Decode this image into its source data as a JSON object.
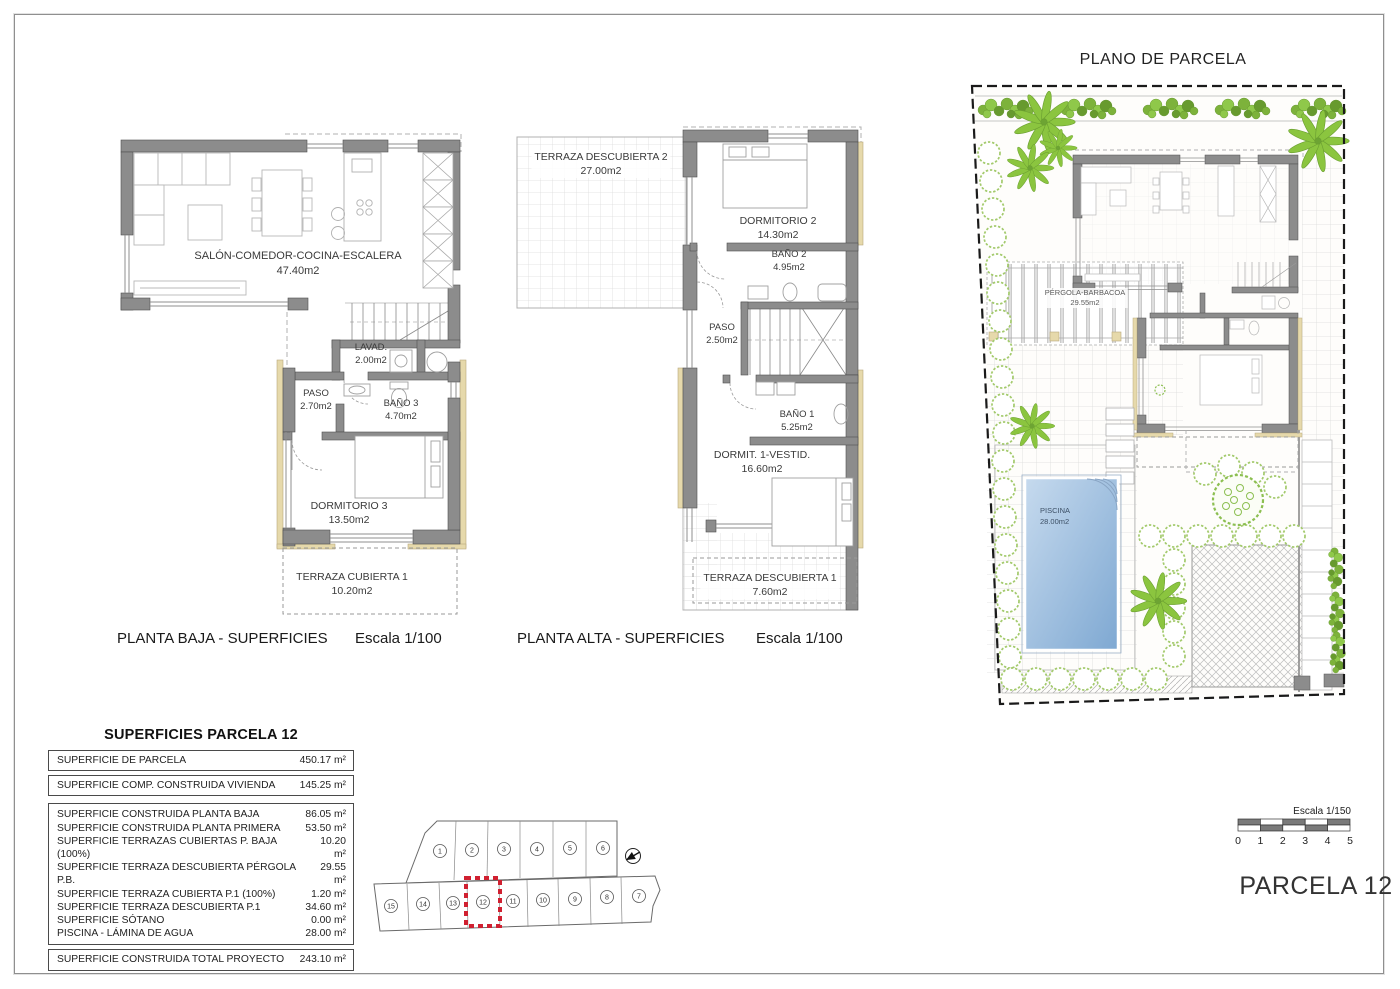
{
  "colors": {
    "wall_gray": "#8c8c8c",
    "beige_accent": "#e6d9ab",
    "vegetation_green": "#8bc53f",
    "pool_blue": "#8fb4da",
    "highlight_red": "#d02030"
  },
  "plans": {
    "baja": {
      "title": "PLANTA BAJA - SUPERFICIES",
      "scale": "Escala 1/100",
      "rooms": [
        {
          "name": "SALÓN-COMEDOR-COCINA-ESCALERA",
          "area": "47.40m2"
        },
        {
          "name": "LAVAD.",
          "area": "2.00m2"
        },
        {
          "name": "PASO",
          "area": "2.70m2"
        },
        {
          "name": "BAÑO 3",
          "area": "4.70m2"
        },
        {
          "name": "DORMITORIO 3",
          "area": "13.50m2"
        },
        {
          "name": "TERRAZA CUBIERTA 1",
          "area": "10.20m2"
        }
      ]
    },
    "alta": {
      "title": "PLANTA ALTA - SUPERFICIES",
      "scale": "Escala 1/100",
      "rooms": [
        {
          "name": "TERRAZA DESCUBIERTA 2",
          "area": "27.00m2"
        },
        {
          "name": "DORMITORIO 2",
          "area": "14.30m2"
        },
        {
          "name": "BAÑO 2",
          "area": "4.95m2"
        },
        {
          "name": "PASO",
          "area": "2.50m2"
        },
        {
          "name": "BAÑO 1",
          "area": "5.25m2"
        },
        {
          "name": "DORMIT. 1-VESTID.",
          "area": "16.60m2"
        },
        {
          "name": "TERRAZA DESCUBIERTA 1",
          "area": "7.60m2"
        }
      ]
    },
    "parcela": {
      "title": "PLANO DE PARCELA",
      "label": "PARCELA 12",
      "rooms": [
        {
          "name": "PÉRGOLA-BARBACOA",
          "area": "29.55m2"
        },
        {
          "name": "PISCINA",
          "area": "28.00m2"
        }
      ]
    }
  },
  "scalebar": {
    "label": "Escala 1/150",
    "ticks": [
      "0",
      "1",
      "2",
      "3",
      "4",
      "5"
    ]
  },
  "plot_map": {
    "top_row": [
      "1",
      "2",
      "3",
      "4",
      "5",
      "6"
    ],
    "bottom_row": [
      "15",
      "14",
      "13",
      "12",
      "11",
      "10",
      "9",
      "8",
      "7"
    ],
    "highlighted_plot": "12"
  },
  "table": {
    "title": "SUPERFICIES PARCELA 12",
    "sections": [
      [
        {
          "label": "SUPERFICIE DE PARCELA",
          "value": "450.17 m²"
        }
      ],
      [
        {
          "label": "SUPERFICIE COMP. CONSTRUIDA VIVIENDA",
          "value": "145.25 m²"
        }
      ],
      [
        {
          "label": "SUPERFICIE CONSTRUIDA PLANTA BAJA",
          "value": "86.05 m²"
        },
        {
          "label": "SUPERFICIE CONSTRUIDA PLANTA PRIMERA",
          "value": "53.50 m²"
        },
        {
          "label": "SUPERFICIE TERRAZAS CUBIERTAS P. BAJA (100%)",
          "value": "10.20 m²"
        },
        {
          "label": "SUPERFICIE TERRAZA DESCUBIERTA PÉRGOLA P.B.",
          "value": "29.55 m²"
        },
        {
          "label": "SUPERFICIE TERRAZA CUBIERTA P.1 (100%)",
          "value": "1.20 m²"
        },
        {
          "label": "SUPERFICIE TERRAZA DESCUBIERTA P.1",
          "value": "34.60 m²"
        },
        {
          "label": "SUPERFICIE SÓTANO",
          "value": "0.00 m²"
        },
        {
          "label": "PISCINA - LÁMINA DE AGUA",
          "value": "28.00 m²"
        }
      ],
      [
        {
          "label": "SUPERFICIE CONSTRUIDA TOTAL PROYECTO",
          "value": "243.10 m²"
        }
      ]
    ]
  }
}
